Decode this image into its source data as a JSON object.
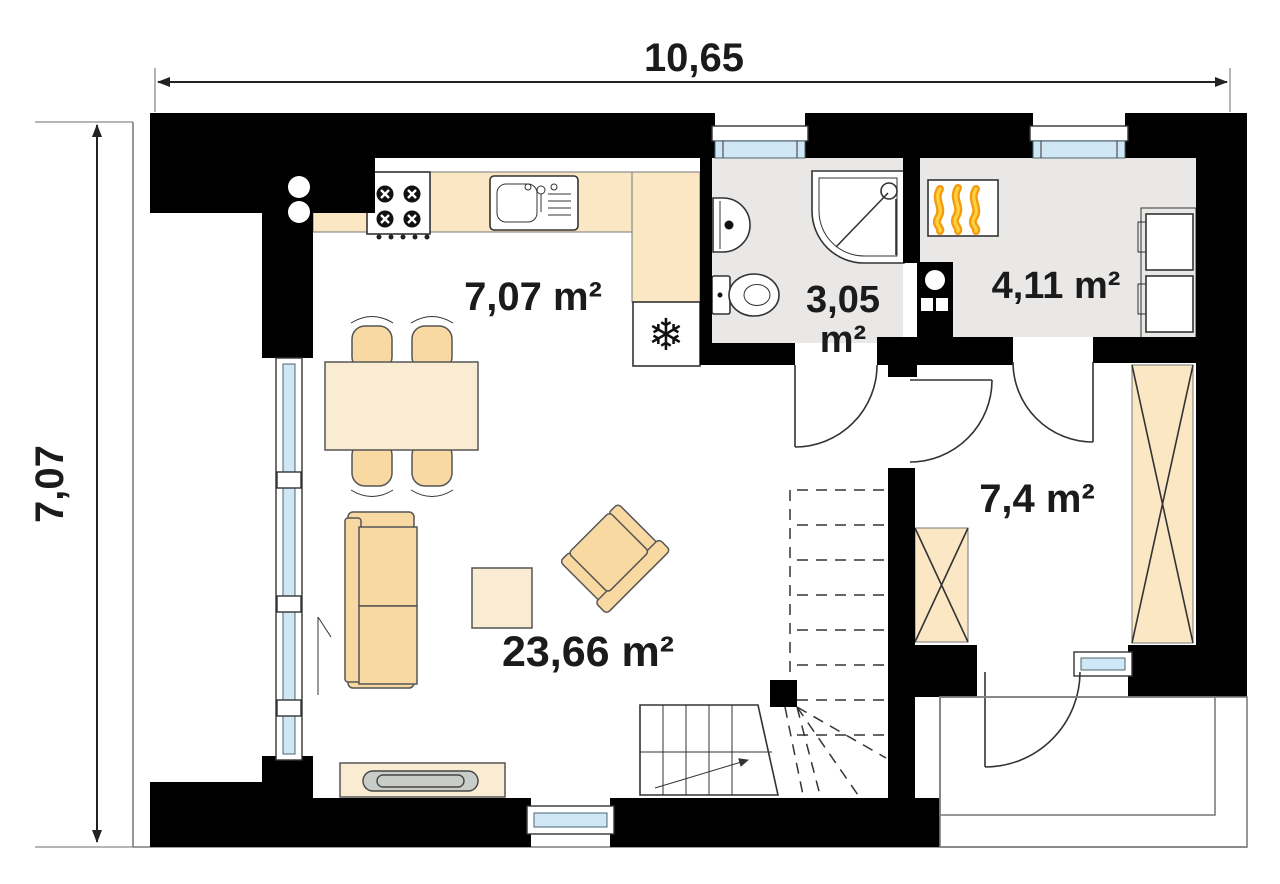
{
  "dims": {
    "width_label": "10,65",
    "height_label": "7,07"
  },
  "rooms": {
    "kitchen": {
      "area_label": "7,07 m²"
    },
    "bathroom": {
      "area_line1": "3,05",
      "area_line2": "m²"
    },
    "boiler_room": {
      "area_label": "4,11 m²"
    },
    "room": {
      "area_label": "7,4 m²"
    },
    "living_room": {
      "area_label": "23,66 m²"
    }
  },
  "icons": {
    "snowflake": "❄"
  },
  "colors": {
    "wall": "#000000",
    "floor": "#e9e8e6",
    "glass": "#cfe6f4",
    "counter": "#fbe7c4",
    "furniture": "#f8d9a2",
    "furniture_light": "#faecd2",
    "tv": "#c9cdc9",
    "flame_orange": "#f39c12",
    "flame_yellow": "#fdd23e",
    "line": "#333333",
    "text": "#1b1b1b"
  }
}
